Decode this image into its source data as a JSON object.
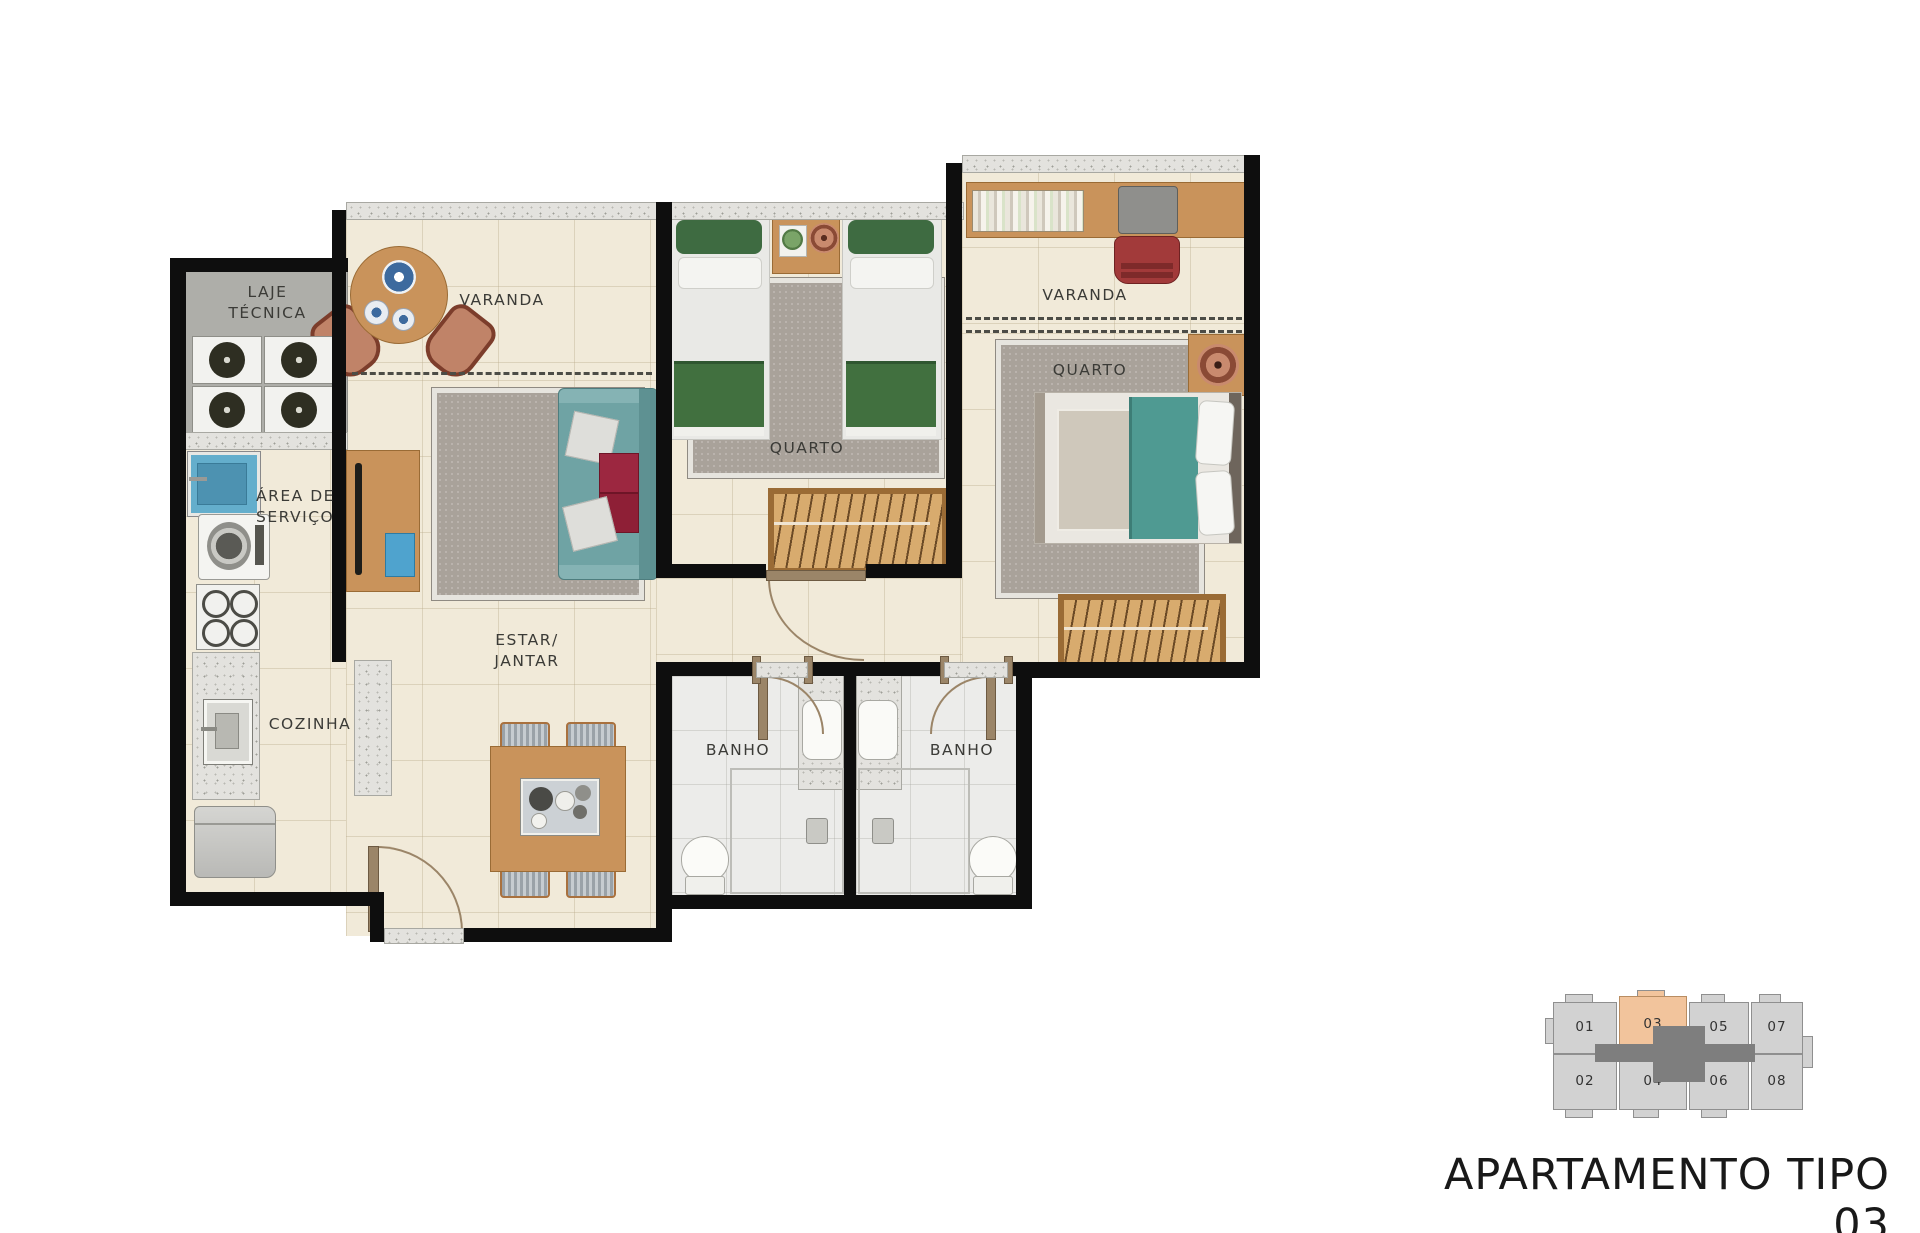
{
  "title": "APARTAMENTO TIPO 03",
  "rooms": {
    "laje": {
      "l1": "LAJE",
      "l2": "TÉCNICA"
    },
    "servico": {
      "l1": "ÁREA DE",
      "l2": "SERVIÇO"
    },
    "cozinha": {
      "label": "COZINHA"
    },
    "estar": {
      "l1": "ESTAR/",
      "l2": "JANTAR"
    },
    "varanda_left": {
      "label": "VARANDA"
    },
    "varanda_right": {
      "label": "VARANDA"
    },
    "quarto1": {
      "label": "QUARTO"
    },
    "quarto2": {
      "label": "QUARTO"
    },
    "banho1": {
      "label": "BANHO"
    },
    "banho2": {
      "label": "BANHO"
    }
  },
  "keyplan": {
    "highlighted_unit": "03",
    "units": [
      "01",
      "03",
      "05",
      "07",
      "02",
      "04",
      "06",
      "08"
    ],
    "unit_color": "#d2d2d2",
    "highlight_color": "#f2c49c",
    "core_color": "#7e7e7e"
  },
  "colors": {
    "wall": "#0e0e0e",
    "floor": "#f1ead9",
    "bath_floor": "#ececea",
    "laje_floor": "#aeaea9",
    "wood": "#c9935b",
    "sofa_teal": "#6fa3a4",
    "bed_green": "#41703f",
    "bed_teal": "#4f9a92",
    "cushion_red": "#9c2740",
    "rug": "#a9a29a",
    "water_blue": "#64aecc",
    "chair_red": "#a23a3a",
    "copper": "#b9745a",
    "title_text": "#191919"
  }
}
